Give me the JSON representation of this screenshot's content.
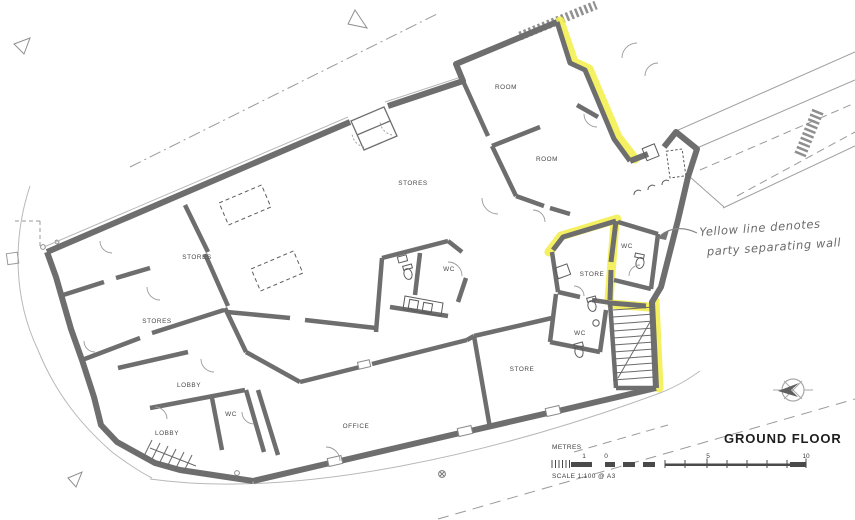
{
  "title_block": {
    "title": "GROUND FLOOR"
  },
  "scale_bar": {
    "units_label": "METRES",
    "ticks": [
      "1",
      "0",
      "5",
      "10"
    ],
    "note": "SCALE 1:100 @ A3"
  },
  "annotation": {
    "line1": "Yellow line denotes",
    "line2": "party separating wall"
  },
  "rooms": {
    "stores_main": "STORES",
    "stores_mid": "STORES",
    "stores_lower": "STORES",
    "room_upper": "ROOM",
    "room_lower": "ROOM",
    "wc_center": "WC",
    "wc_upper_right": "WC",
    "wc_mid_right": "WC",
    "wc_lobby": "WC",
    "store_mid": "STORE",
    "store_lower": "STORE",
    "lobby_upper": "LOBBY",
    "lobby_lower": "LOBBY",
    "office": "OFFICE"
  },
  "colors": {
    "wall": "#6e6e6e",
    "party_wall": "#f3ef52",
    "thin_line": "#b8b8b8",
    "label_text": "#474747"
  }
}
